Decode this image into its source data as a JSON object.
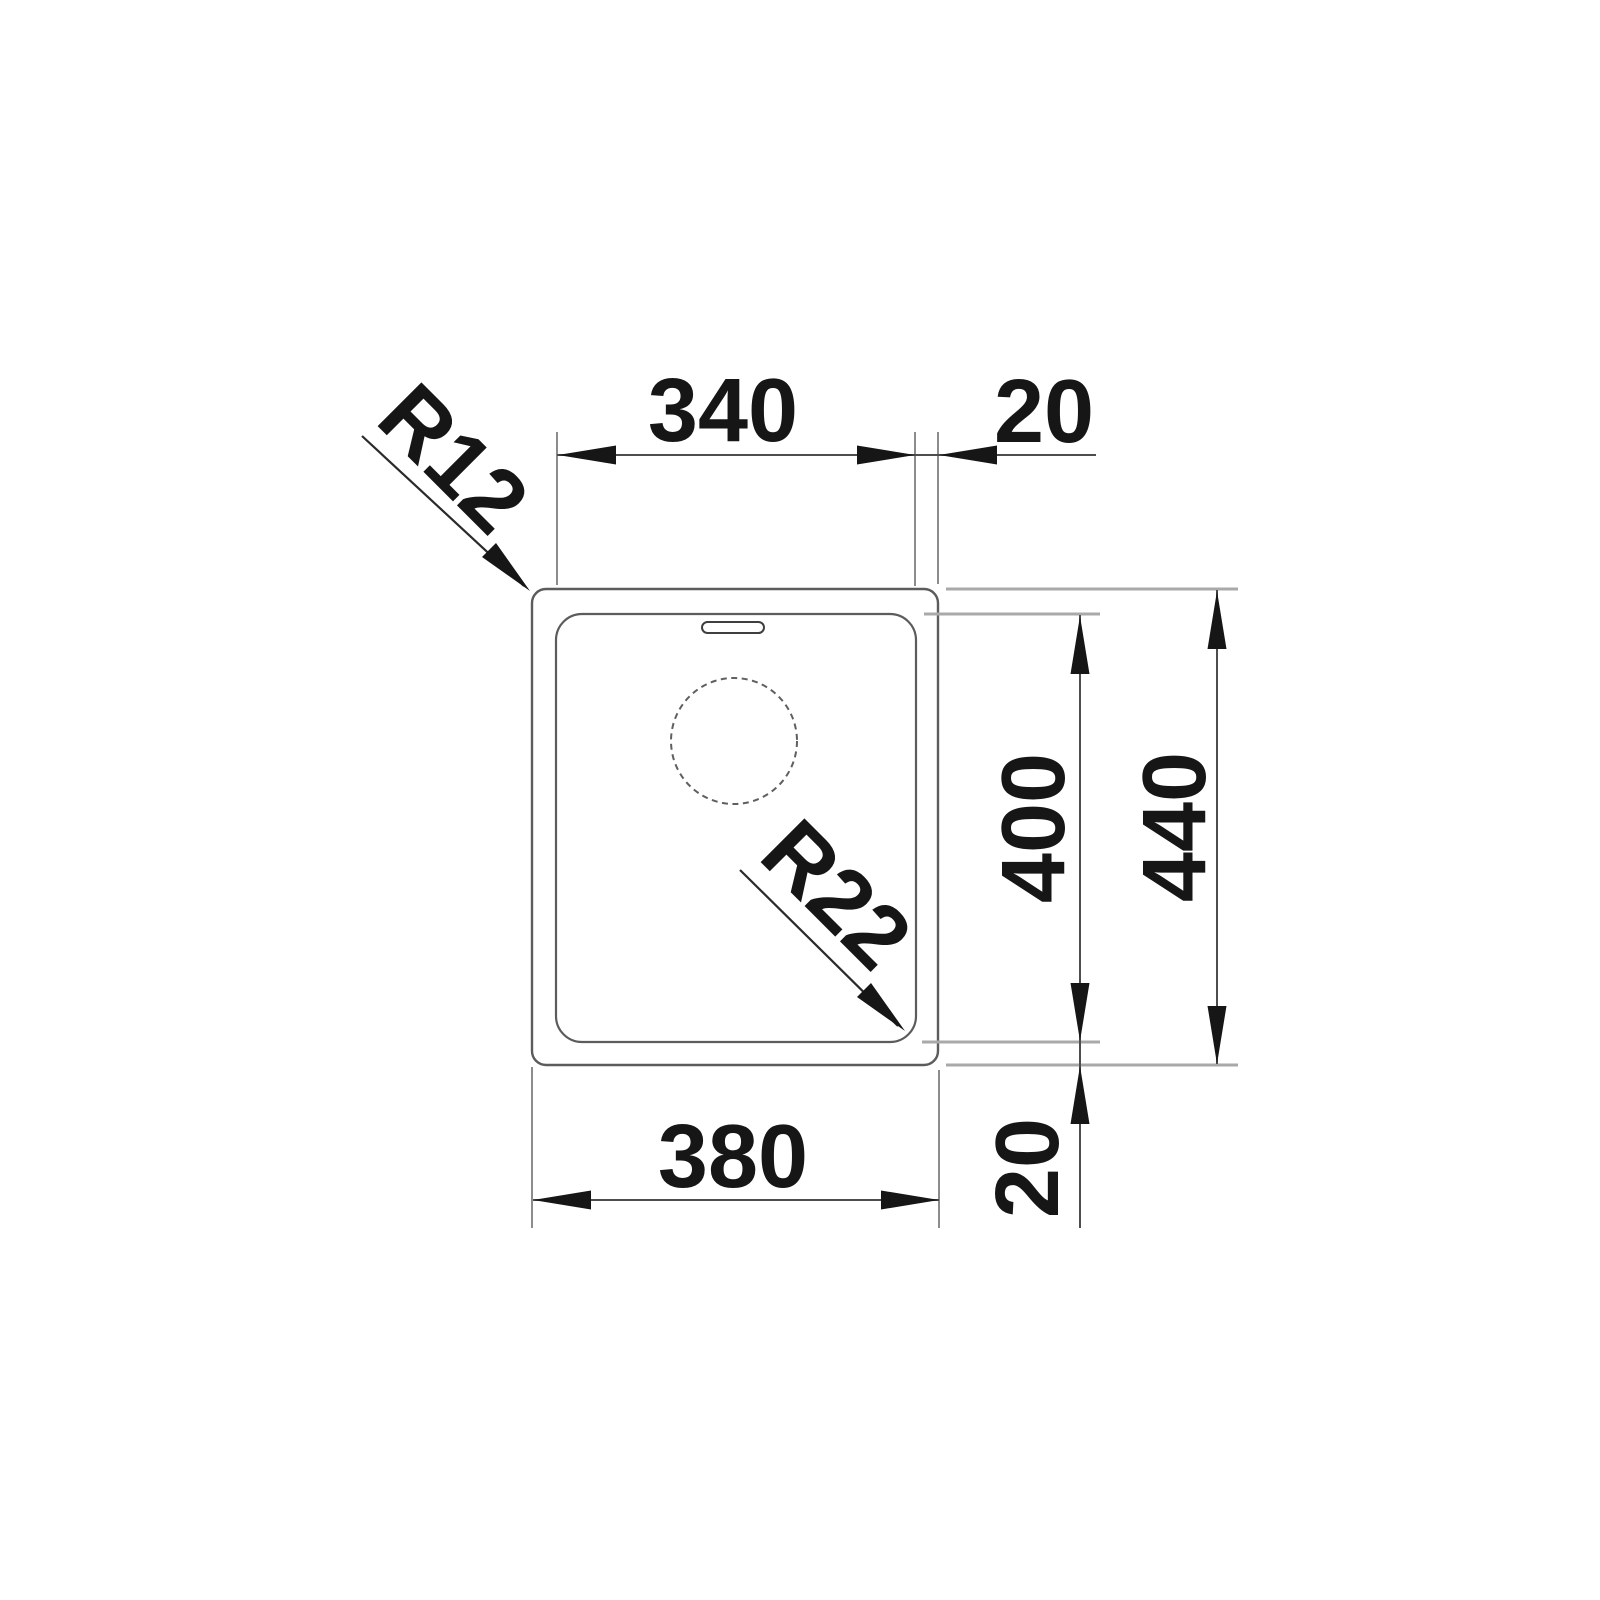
{
  "drawing": {
    "subject": "Undermount kitchen sink installation drawing, top view with millimetre dimensions",
    "labels": {
      "inner_width": "340",
      "rim_offset_top": "20",
      "outer_width": "380",
      "inner_depth": "400",
      "outer_depth": "440",
      "rim_offset_bottom": "20",
      "outer_corner_radius": "R12",
      "bowl_corner_radius": "R22"
    },
    "features": {
      "drain_hole": "circle",
      "overflow_slot": "rounded slot at top of bowl"
    },
    "colors": {
      "background": "#ffffff",
      "ink": "#161616",
      "outline": "#5c5c5c",
      "extension_line": "#a9a9a9",
      "dimension_line": "#4d4d4d"
    }
  }
}
